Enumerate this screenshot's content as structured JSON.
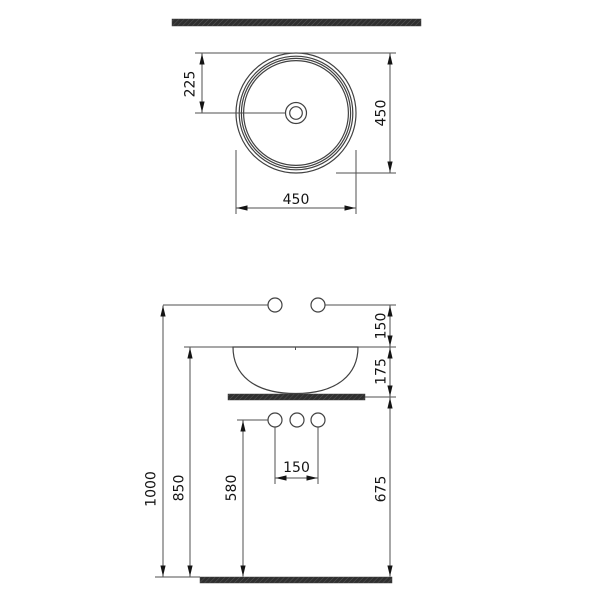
{
  "drawing": {
    "colors": {
      "background": "#ffffff",
      "object_line": "#414141",
      "dim_line": "#4f4f4f",
      "text": "#141414",
      "bar_fill": "#2f2f2f",
      "bar_hatch": "#585858"
    },
    "top_view": {
      "center_offset": "225",
      "depth": "450",
      "width": "450"
    },
    "front_view": {
      "rim_to_faucet": "150",
      "basin_height": "175",
      "overall_height": "1000",
      "rim_height": "850",
      "supply_height": "580",
      "counter_clearance": "675",
      "hole_spacing": "150"
    }
  }
}
